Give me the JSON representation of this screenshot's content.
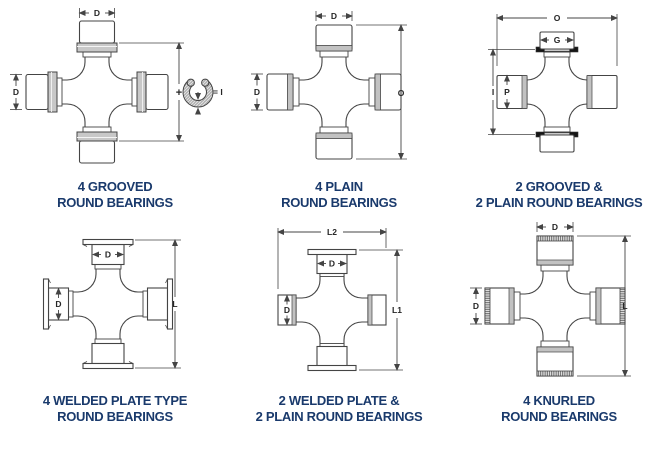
{
  "colors": {
    "caption": "#1a3a6c",
    "outline": "#444444",
    "dim_text": "#262626",
    "collar_gray": "#c8c8c8",
    "band_gray": "#c2c2c2",
    "ring_black": "#151515",
    "background": "#ffffff"
  },
  "diagrams": [
    {
      "id": "4-grooved-round-bearings",
      "caption_line1": "4 GROOVED",
      "caption_line2": "ROUND BEARINGS",
      "dims": {
        "top": "D",
        "left": "D",
        "right_plus": "+",
        "ring_equals": "= I"
      }
    },
    {
      "id": "4-plain-round-bearings",
      "caption_line1": "4 PLAIN",
      "caption_line2": "ROUND BEARINGS",
      "dims": {
        "top": "D",
        "left": "D",
        "right": "O"
      }
    },
    {
      "id": "2-grooved-2-plain-round-bearings",
      "caption_line1": "2 GROOVED &",
      "caption_line2": "2 PLAIN ROUND BEARINGS",
      "dims": {
        "top": "O",
        "cap": "G",
        "left": "I",
        "bearing": "P"
      }
    },
    {
      "id": "4-welded-plate-type-round-bearings",
      "caption_line1": "4 WELDED PLATE TYPE",
      "caption_line2": "ROUND BEARINGS",
      "dims": {
        "cap_top": "D",
        "cap_left": "D",
        "right": "L"
      }
    },
    {
      "id": "2-welded-plate-2-plain-round-bearings",
      "caption_line1": "2 WELDED PLATE &",
      "caption_line2": "2 PLAIN ROUND BEARINGS",
      "dims": {
        "top": "L2",
        "cap_top": "D",
        "cap_left": "D",
        "right": "L1"
      }
    },
    {
      "id": "4-knurled-round-bearings",
      "caption_line1": "4 KNURLED",
      "caption_line2": "ROUND BEARINGS",
      "dims": {
        "top": "D",
        "left": "D",
        "right": "L"
      }
    }
  ]
}
